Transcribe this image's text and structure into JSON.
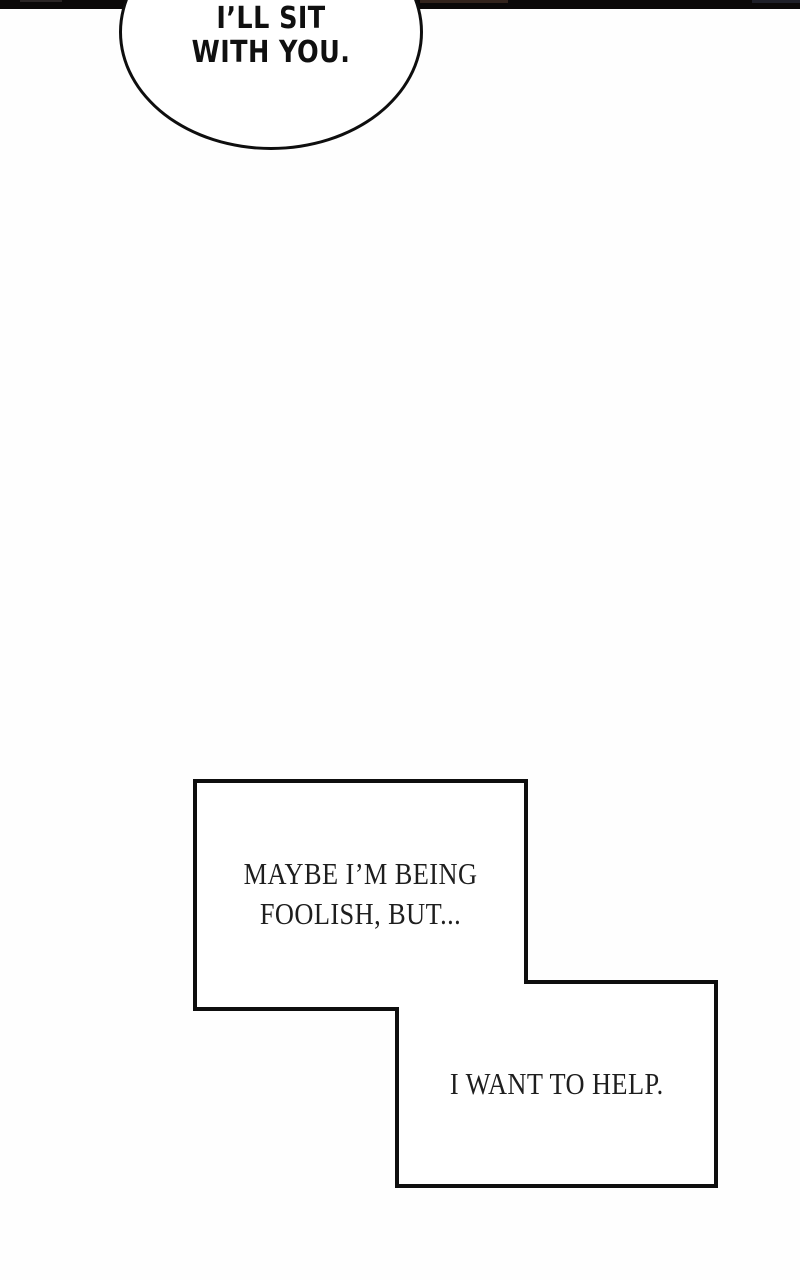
{
  "comic": {
    "speech_bubble": {
      "line1": "I’LL SIT",
      "line2": "WITH YOU."
    },
    "caption_box_1": {
      "line1": "MAYBE I’M BEING",
      "line2": "FOOLISH, BUT..."
    },
    "caption_box_2": {
      "line1": "I WANT TO HELP."
    }
  },
  "colors": {
    "background": "#ffffff",
    "ink_outline": "#0e0e0e",
    "panel_bar": "#0b0909",
    "bubble_text": "#101010",
    "caption_text": "#1e1e1e"
  }
}
